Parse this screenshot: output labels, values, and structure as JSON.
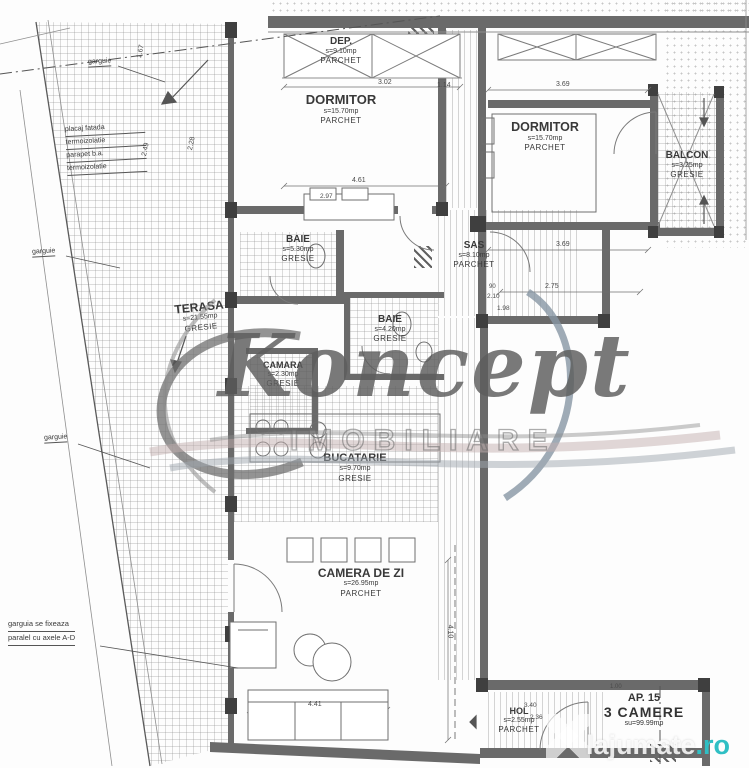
{
  "rooms": [
    {
      "name": "DEP.",
      "area": "s=9.10mp",
      "finish": "PARCHET"
    },
    {
      "name": "DORMITOR",
      "area": "s=15.70mp",
      "finish": "PARCHET"
    },
    {
      "name": "DORMITOR",
      "area": "s=15.70mp",
      "finish": "PARCHET"
    },
    {
      "name": "BALCON",
      "area": "s=3.25mp",
      "finish": "GRESIE"
    },
    {
      "name": "BAIE",
      "area": "s=5.30mp",
      "finish": "GRESIE"
    },
    {
      "name": "SAS",
      "area": "s=8.10mp",
      "finish": "PARCHET"
    },
    {
      "name": "BAIE",
      "area": "s=4.20mp",
      "finish": "GRESIE"
    },
    {
      "name": "TERASA",
      "area": "s=21.55mp",
      "finish": "GRESIE"
    },
    {
      "name": "CAMARA",
      "area": "s=2.30mp",
      "finish": "GRESIE"
    },
    {
      "name": "BUCATARIE",
      "area": "s=9.70mp",
      "finish": "GRESIE"
    },
    {
      "name": "CAMERA DE ZI",
      "area": "s=26.95mp",
      "finish": "PARCHET"
    },
    {
      "name": "HOL",
      "area": "s=2.55mp",
      "finish": "PARCHET"
    }
  ],
  "apartment": {
    "number": "AP. 15",
    "type": "3 CAMERE",
    "total_area": "su=99.99mp"
  },
  "annotations": {
    "garguie_top": "garguie",
    "garguie_mid": "garguie",
    "garguie_low": "garguie",
    "facade_lines": [
      "placaj fatada",
      "termoizolatie",
      "parapet b.a.",
      "termoizolatie"
    ],
    "gutter_line1": "garguia se fixeaza",
    "gutter_line2": "paralel cu axele A-D"
  },
  "dims": [
    "3.02",
    "3.69",
    "1.14",
    "4.61",
    "2.97",
    "3.69",
    "2.75",
    "90",
    "2.10",
    "1.98",
    "4.41",
    "3.40",
    "2.36",
    "1.00",
    "4.10",
    "2.49",
    "2.28",
    "1.67"
  ],
  "watermark": {
    "brand": "Koncept",
    "subtitle": "IMOBILIARE"
  },
  "site_watermark": {
    "name": "lajumate",
    "tld": ".ro"
  },
  "colors": {
    "wall": "#6a6a6a",
    "accent_teal": "#2fbfc4",
    "watermark_gray": "#5d5d5d"
  }
}
